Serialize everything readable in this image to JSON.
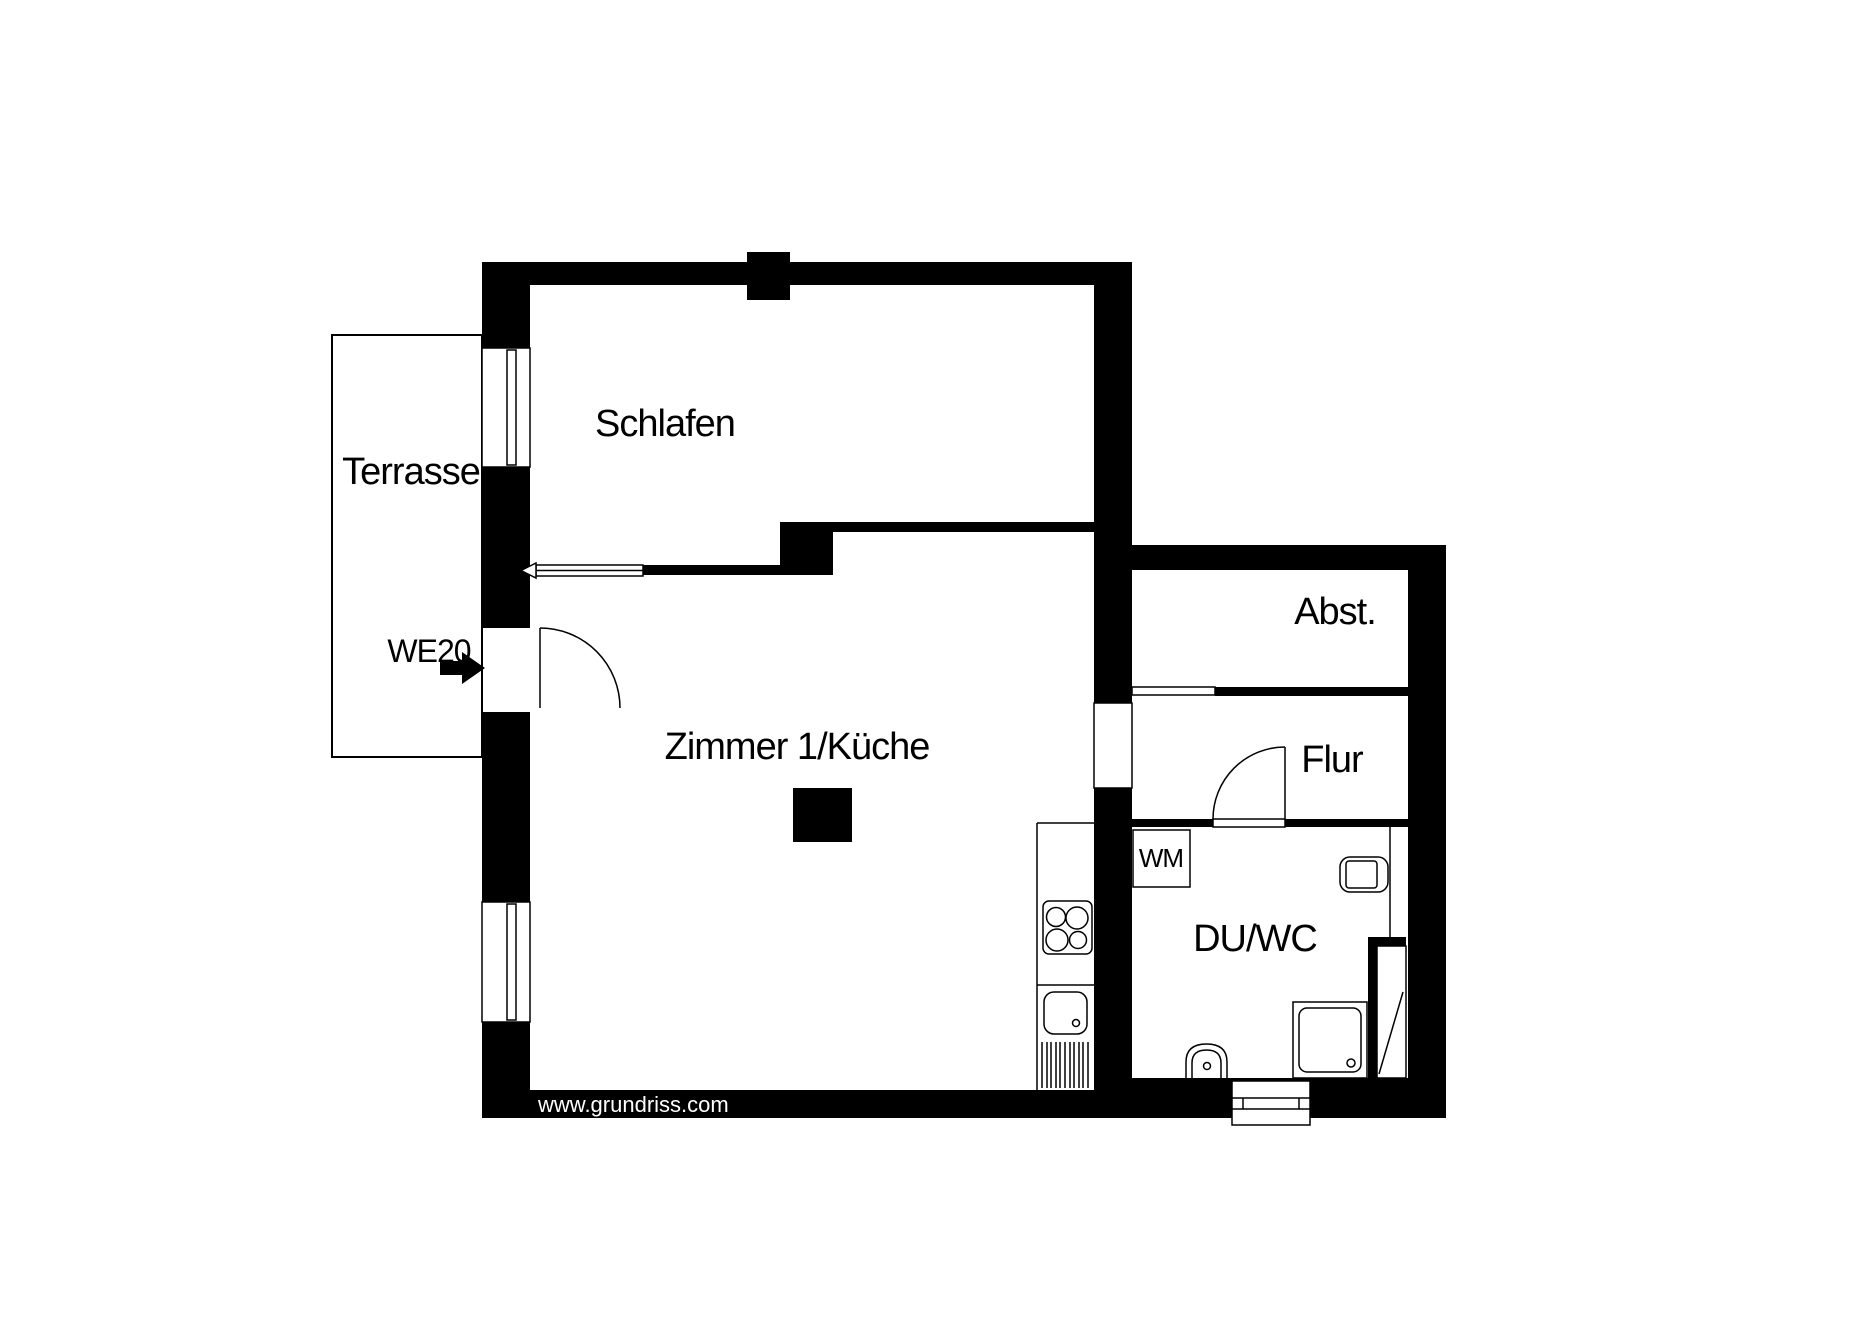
{
  "colors": {
    "wall": "#000000",
    "background": "#ffffff",
    "text": "#000000",
    "watermark_text": "#ffffff"
  },
  "unit": {
    "label": "WE20",
    "entrance_arrow_icon": "right-arrow"
  },
  "rooms": {
    "terrasse": {
      "label": "Terrasse"
    },
    "schlafen": {
      "label": "Schlafen"
    },
    "zimmer_kueche": {
      "label": "Zimmer 1/Küche"
    },
    "abstellraum": {
      "label": "Abst."
    },
    "flur": {
      "label": "Flur"
    },
    "du_wc": {
      "label": "DU/WC"
    }
  },
  "fixtures": {
    "washing_machine": {
      "label": "WM"
    },
    "stove": {
      "icon": "stove-4-burners-icon"
    },
    "kitchen_sink": {
      "icon": "kitchen-sink-icon"
    },
    "drainer": {
      "icon": "hatched-drainer-icon"
    },
    "shower": {
      "icon": "shower-tray-icon"
    },
    "toilet": {
      "icon": "toilet-icon"
    },
    "washbasin": {
      "icon": "washbasin-icon"
    },
    "shaft": {
      "icon": "installation-shaft-icon"
    }
  },
  "watermark": {
    "label": "www.grundriss.com"
  }
}
